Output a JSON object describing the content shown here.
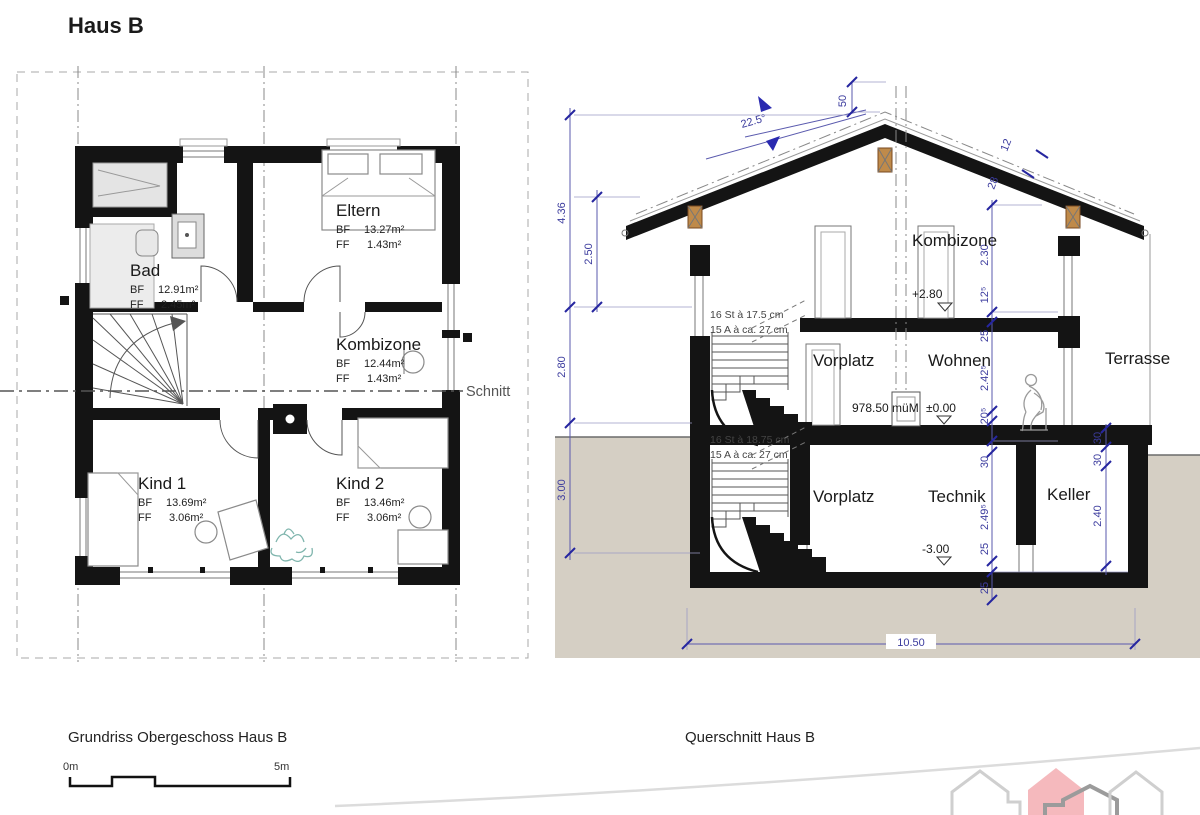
{
  "title": "Haus B",
  "plan": {
    "caption": "Grundriss Obergeschoss Haus B",
    "schnitt_label": "Schnitt",
    "rooms": [
      {
        "name": "Bad",
        "l1": "BF",
        "v1": "12.91m²",
        "l2": "FF",
        "v2": "2.45m²"
      },
      {
        "name": "Eltern",
        "l1": "BF",
        "v1": "13.27m²",
        "l2": "FF",
        "v2": "1.43m²"
      },
      {
        "name": "Kombizone",
        "l1": "BF",
        "v1": "12.44m²",
        "l2": "FF",
        "v2": "1.43m²"
      },
      {
        "name": "Kind 1",
        "l1": "BF",
        "v1": "13.69m²",
        "l2": "FF",
        "v2": "3.06m²"
      },
      {
        "name": "Kind 2",
        "l1": "BF",
        "v1": "13.46m²",
        "l2": "FF",
        "v2": "3.06m²"
      }
    ],
    "scalebar": {
      "start": "0m",
      "end": "5m"
    }
  },
  "section": {
    "caption": "Querschnitt Haus B",
    "rooms": {
      "og": "Kombizone",
      "eg1": "Vorplatz",
      "eg2": "Wohnen",
      "outside": "Terrasse",
      "ug1": "Vorplatz",
      "ug2": "Technik",
      "ug3": "Keller"
    },
    "levels": {
      "og": "+2.80",
      "datum": "978.50 müM",
      "zero": "±0.00",
      "ug": "-3.00"
    },
    "stairs": {
      "upper1": "16 St à 17.5 cm",
      "upper2": "15 A à ca. 27 cm",
      "lower1": "16 St à 18.75 cm",
      "lower2": "15 A à ca. 27 cm"
    },
    "roof": {
      "angle": "22.5°",
      "ridge": "50",
      "t1": "12",
      "t2": "28"
    },
    "dims": {
      "left": {
        "total": "4.36",
        "knee": "2.50",
        "eg": "2.80",
        "ug": "3.00"
      },
      "right": [
        "2.30",
        "12⁵",
        "25",
        "2.42⁵",
        "20⁵",
        "30",
        "2.49⁵",
        "25",
        "25"
      ],
      "keller": [
        "30",
        "30",
        "2.40"
      ],
      "width": "10.50"
    }
  }
}
